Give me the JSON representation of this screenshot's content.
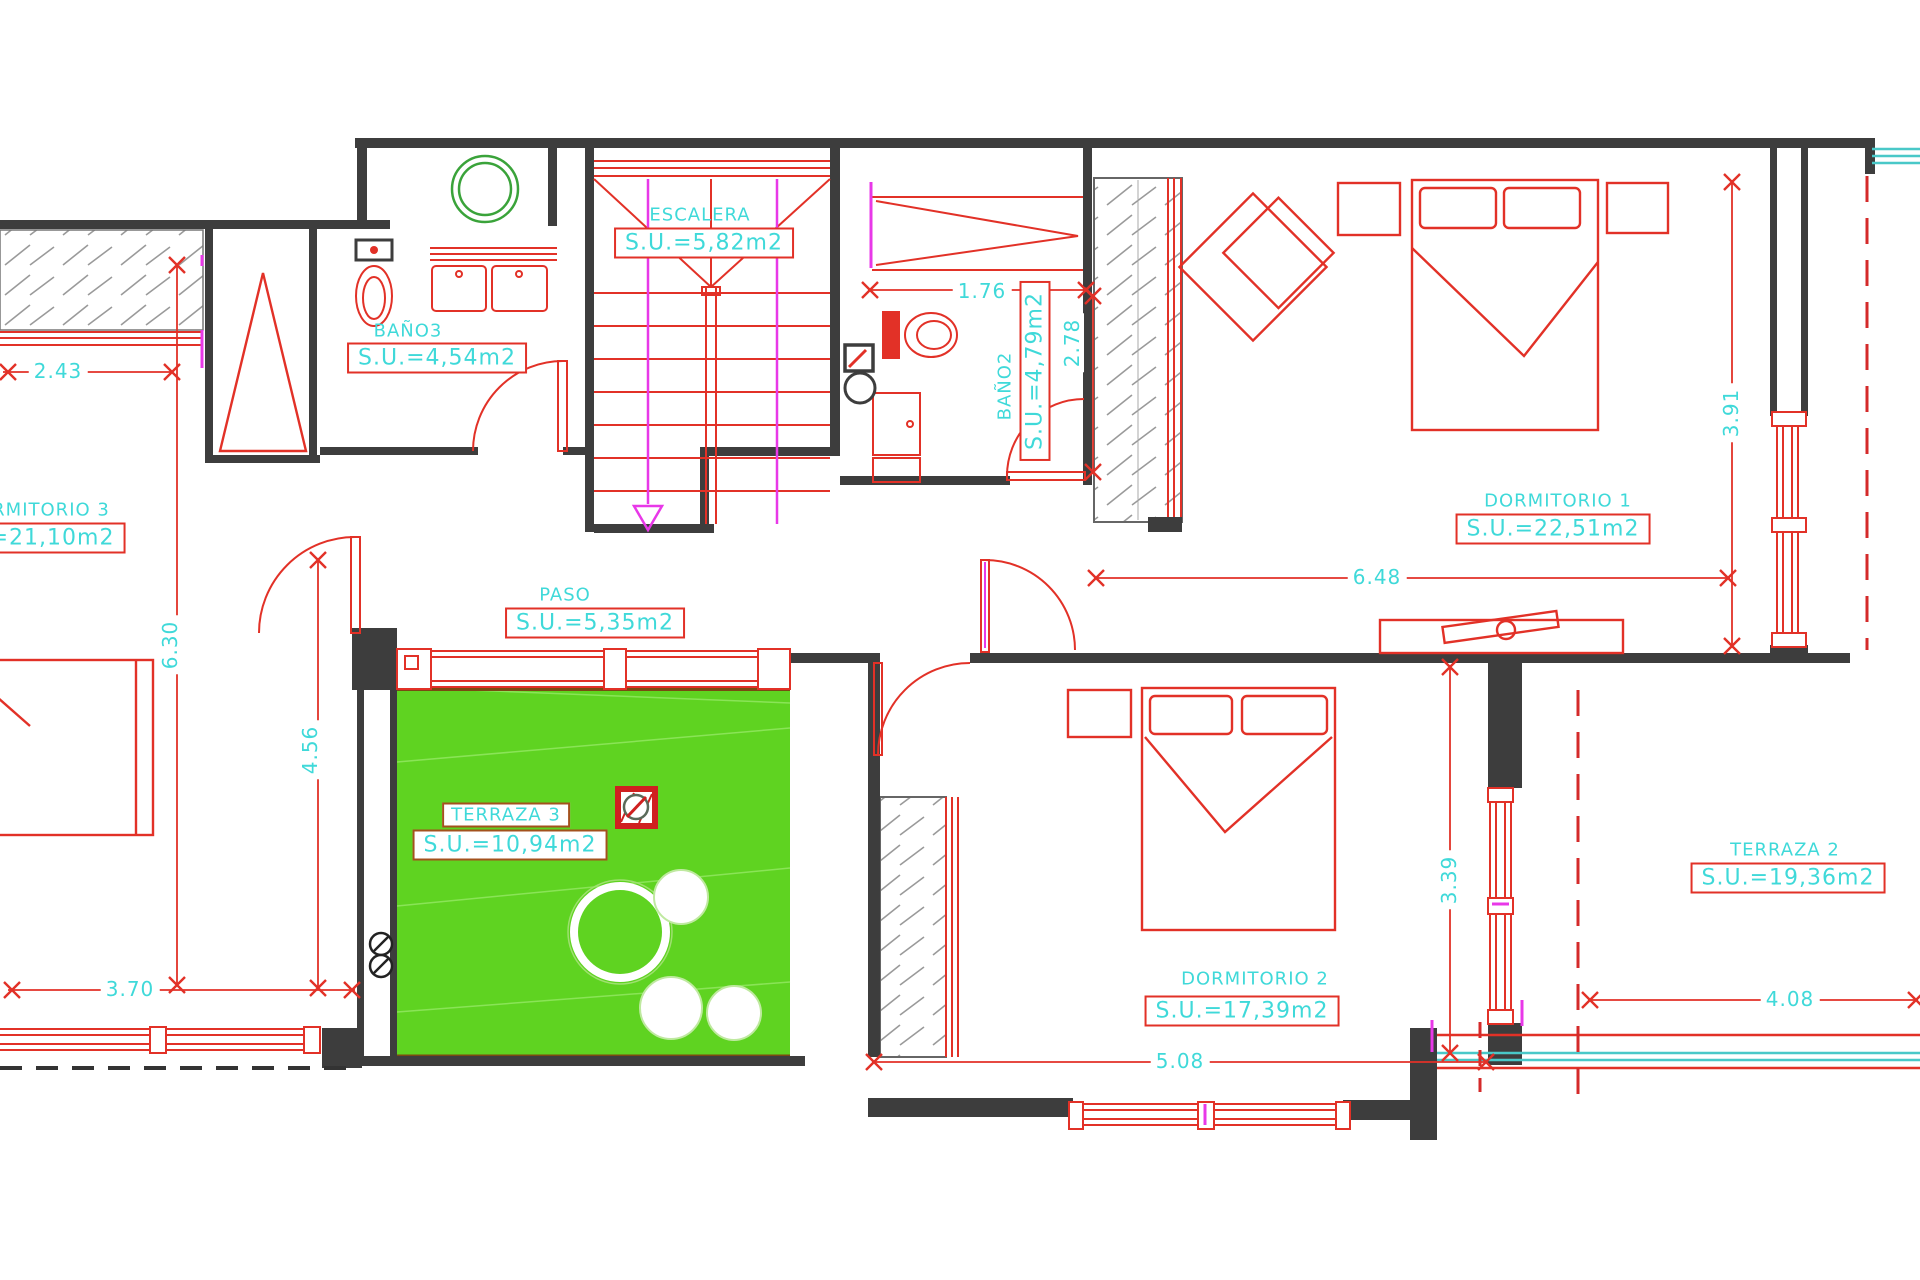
{
  "plan_title": "floor-plan-upper-level",
  "colors": {
    "wall_dark": "#3d3d3d",
    "drawing_red": "#e23127",
    "label_cyan": "#3fd9d9",
    "terrace_green": "#5fd321",
    "accent_magenta": "#e838e8",
    "appliance_green": "#3aa33a",
    "window_cyan": "#49c8c8",
    "terrace_label_border": "#a3511d"
  },
  "rooms": [
    {
      "name": "ESCALERA",
      "area": "S.U.=5,82m2"
    },
    {
      "name": "BAÑO3",
      "area": "S.U.=4,54m2"
    },
    {
      "name": "BAÑO2",
      "area": "S.U.=4,79m2"
    },
    {
      "name": "DORMITORIO 1",
      "area": "S.U.=22,51m2"
    },
    {
      "name": "DORMITORIO 3",
      "area": "S.U.=21,10m2"
    },
    {
      "name": "PASO",
      "area": "S.U.=5,35m2"
    },
    {
      "name": "TERRAZA 3",
      "area": "S.U.=10,94m2"
    },
    {
      "name": "DORMITORIO 2",
      "area": "S.U.=17,39m2"
    },
    {
      "name": "TERRAZA 2",
      "area": "S.U.=19,36m2"
    }
  ],
  "dimensions": [
    {
      "value": "2.43",
      "orientation": "horizontal"
    },
    {
      "value": "1.76",
      "orientation": "horizontal"
    },
    {
      "value": "2.78",
      "orientation": "vertical"
    },
    {
      "value": "3.91",
      "orientation": "vertical"
    },
    {
      "value": "6.48",
      "orientation": "horizontal"
    },
    {
      "value": "6.30",
      "orientation": "vertical"
    },
    {
      "value": "4.56",
      "orientation": "vertical"
    },
    {
      "value": "3.70",
      "orientation": "horizontal"
    },
    {
      "value": "3.39",
      "orientation": "vertical"
    },
    {
      "value": "5.08",
      "orizontal": "horizontal"
    },
    {
      "value": "4.08",
      "orientation": "horizontal"
    }
  ],
  "icons": [
    {
      "name": "drain-icon"
    },
    {
      "name": "downpipe-icon"
    },
    {
      "name": "washing-machine-icon"
    },
    {
      "name": "stair-direction-arrow-icon"
    }
  ]
}
